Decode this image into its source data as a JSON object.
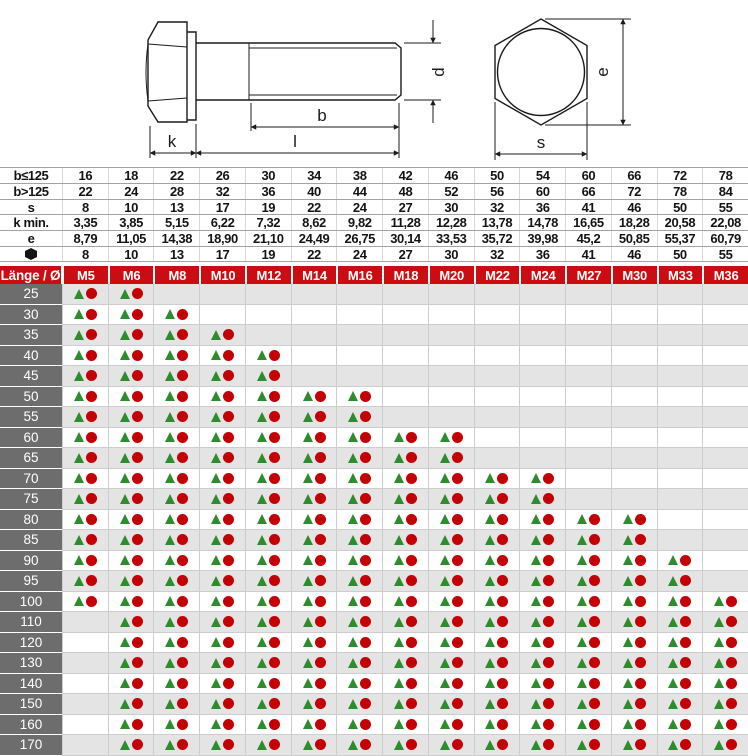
{
  "colors": {
    "header_red": "#c90d12",
    "label_gray": "#6d6d6d",
    "row_alt": "#e4e4e4",
    "tri_green": "#2e8c2e",
    "dot_red": "#c30005",
    "grid_line": "#cdcdcd",
    "dim_hline": "#a3a3a3",
    "dim_vline": "#d8d8d8"
  },
  "diagram": {
    "labels": {
      "k": "k",
      "b": "b",
      "l": "l",
      "d": "d",
      "e": "e",
      "s": "s"
    }
  },
  "dim_table": {
    "rows": [
      {
        "label": "b≤125",
        "values": [
          "16",
          "18",
          "22",
          "26",
          "30",
          "34",
          "38",
          "42",
          "46",
          "50",
          "54",
          "60",
          "66",
          "72",
          "78"
        ]
      },
      {
        "label": "b>125",
        "values": [
          "22",
          "24",
          "28",
          "32",
          "36",
          "40",
          "44",
          "48",
          "52",
          "56",
          "60",
          "66",
          "72",
          "78",
          "84"
        ]
      },
      {
        "label": "s",
        "values": [
          "8",
          "10",
          "13",
          "17",
          "19",
          "22",
          "24",
          "27",
          "30",
          "32",
          "36",
          "41",
          "46",
          "50",
          "55"
        ]
      },
      {
        "label": "k min.",
        "values": [
          "3,35",
          "3,85",
          "5,15",
          "6,22",
          "7,32",
          "8,62",
          "9,82",
          "11,28",
          "12,28",
          "13,78",
          "14,78",
          "16,65",
          "18,28",
          "20,58",
          "22,08"
        ]
      },
      {
        "label": "e",
        "values": [
          "8,79",
          "11,05",
          "14,38",
          "18,90",
          "21,10",
          "24,49",
          "26,75",
          "30,14",
          "33,53",
          "35,72",
          "39,98",
          "45,2",
          "50,85",
          "55,37",
          "60,79"
        ]
      },
      {
        "label": "",
        "icon": "hex-key-icon",
        "values": [
          "8",
          "10",
          "13",
          "17",
          "19",
          "22",
          "24",
          "27",
          "30",
          "32",
          "36",
          "41",
          "46",
          "50",
          "55"
        ]
      }
    ]
  },
  "matrix": {
    "corner_label": "Länge / Ø",
    "columns": [
      "M5",
      "M6",
      "M8",
      "M10",
      "M12",
      "M14",
      "M16",
      "M18",
      "M20",
      "M22",
      "M24",
      "M27",
      "M30",
      "M33",
      "M36"
    ],
    "cell_symbols": [
      "green-triangle",
      "red-circle"
    ],
    "rows": [
      {
        "length": "25",
        "first": "M5",
        "last": "M6"
      },
      {
        "length": "30",
        "first": "M5",
        "last": "M8"
      },
      {
        "length": "35",
        "first": "M5",
        "last": "M10"
      },
      {
        "length": "40",
        "first": "M5",
        "last": "M12"
      },
      {
        "length": "45",
        "first": "M5",
        "last": "M12"
      },
      {
        "length": "50",
        "first": "M5",
        "last": "M16"
      },
      {
        "length": "55",
        "first": "M5",
        "last": "M16"
      },
      {
        "length": "60",
        "first": "M5",
        "last": "M20"
      },
      {
        "length": "65",
        "first": "M5",
        "last": "M20"
      },
      {
        "length": "70",
        "first": "M5",
        "last": "M24"
      },
      {
        "length": "75",
        "first": "M5",
        "last": "M24"
      },
      {
        "length": "80",
        "first": "M5",
        "last": "M30"
      },
      {
        "length": "85",
        "first": "M5",
        "last": "M30"
      },
      {
        "length": "90",
        "first": "M5",
        "last": "M33"
      },
      {
        "length": "95",
        "first": "M5",
        "last": "M33"
      },
      {
        "length": "100",
        "first": "M5",
        "last": "M36"
      },
      {
        "length": "110",
        "first": "M6",
        "last": "M36"
      },
      {
        "length": "120",
        "first": "M6",
        "last": "M36"
      },
      {
        "length": "130",
        "first": "M6",
        "last": "M36"
      },
      {
        "length": "140",
        "first": "M6",
        "last": "M36"
      },
      {
        "length": "150",
        "first": "M6",
        "last": "M36"
      },
      {
        "length": "160",
        "first": "M6",
        "last": "M36"
      },
      {
        "length": "170",
        "first": "M6",
        "last": "M36"
      }
    ]
  }
}
